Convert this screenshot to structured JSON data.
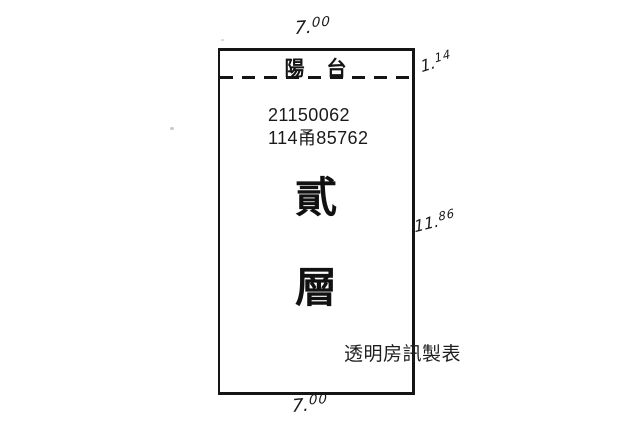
{
  "canvas": {
    "background": "#ffffff"
  },
  "colors": {
    "ink": "#151515",
    "credit_text": "#1f1f1f"
  },
  "floor_plan": {
    "balcony_label": "陽　台",
    "registration": {
      "line1": "21150062",
      "line2": "114甬85762"
    },
    "floor_label": {
      "top_char": "貳",
      "bottom_char": "層"
    },
    "dimensions": {
      "top_width": {
        "value": "7.00",
        "int": "7.",
        "frac": "00"
      },
      "balcony_depth": {
        "value": "1.14",
        "int": "1.",
        "frac": "14"
      },
      "right_depth": {
        "value": "11.86",
        "int": "11.",
        "frac": "86"
      },
      "bottom_width": {
        "value": "7.00",
        "int": "7.",
        "frac": "00"
      }
    }
  },
  "credit": "透明房訊製表"
}
